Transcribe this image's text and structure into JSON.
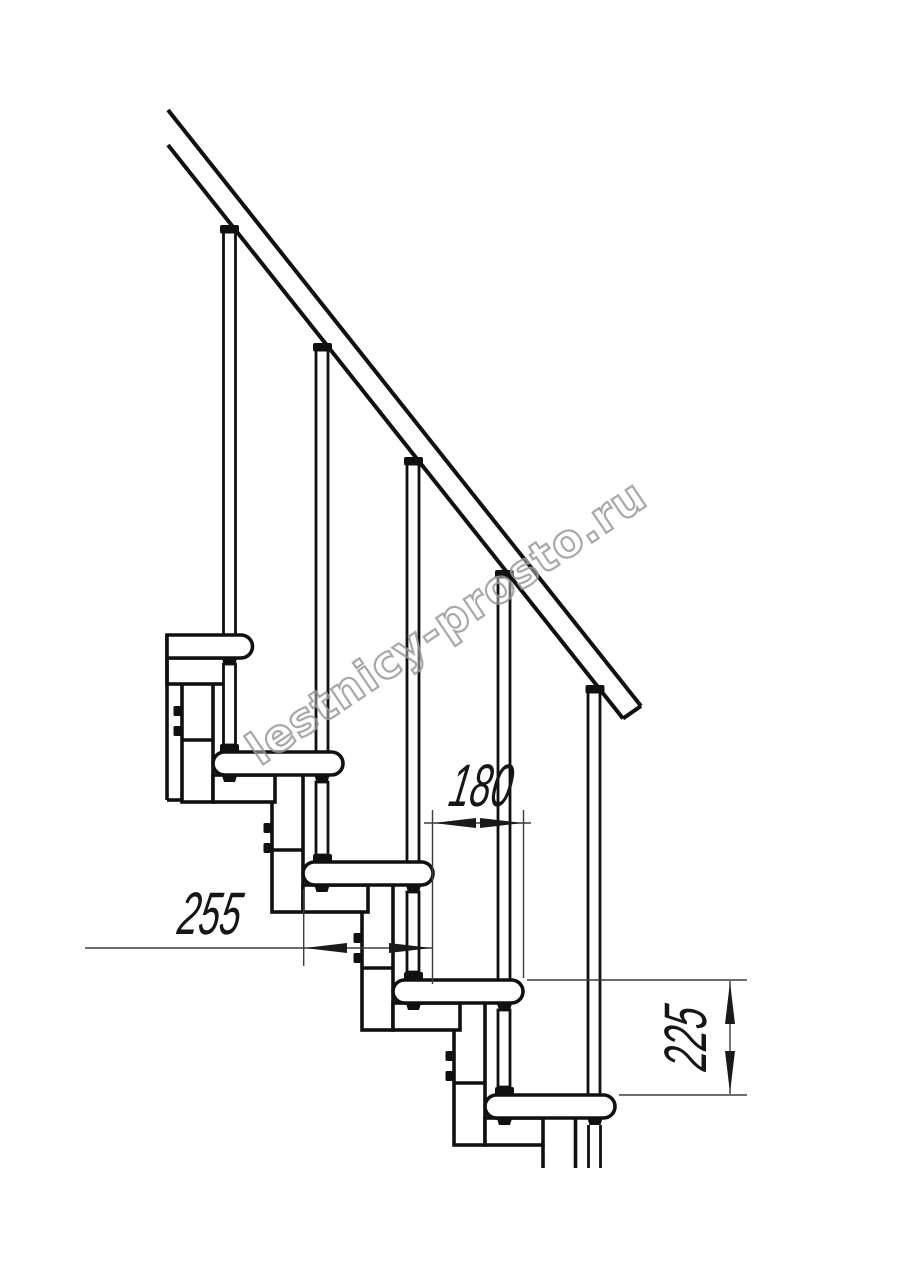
{
  "drawing": {
    "type": "staircase-side-view-technical-drawing",
    "background": "#ffffff",
    "line_color": "#101010",
    "thin_line_color": "#3c3c3c",
    "dimensions": {
      "step_run_mm": "180",
      "tread_depth_mm": "255",
      "step_rise_mm": "225"
    },
    "watermark": {
      "text": "lestnicy-prosto.ru",
      "color": "#9a9a9a"
    }
  }
}
